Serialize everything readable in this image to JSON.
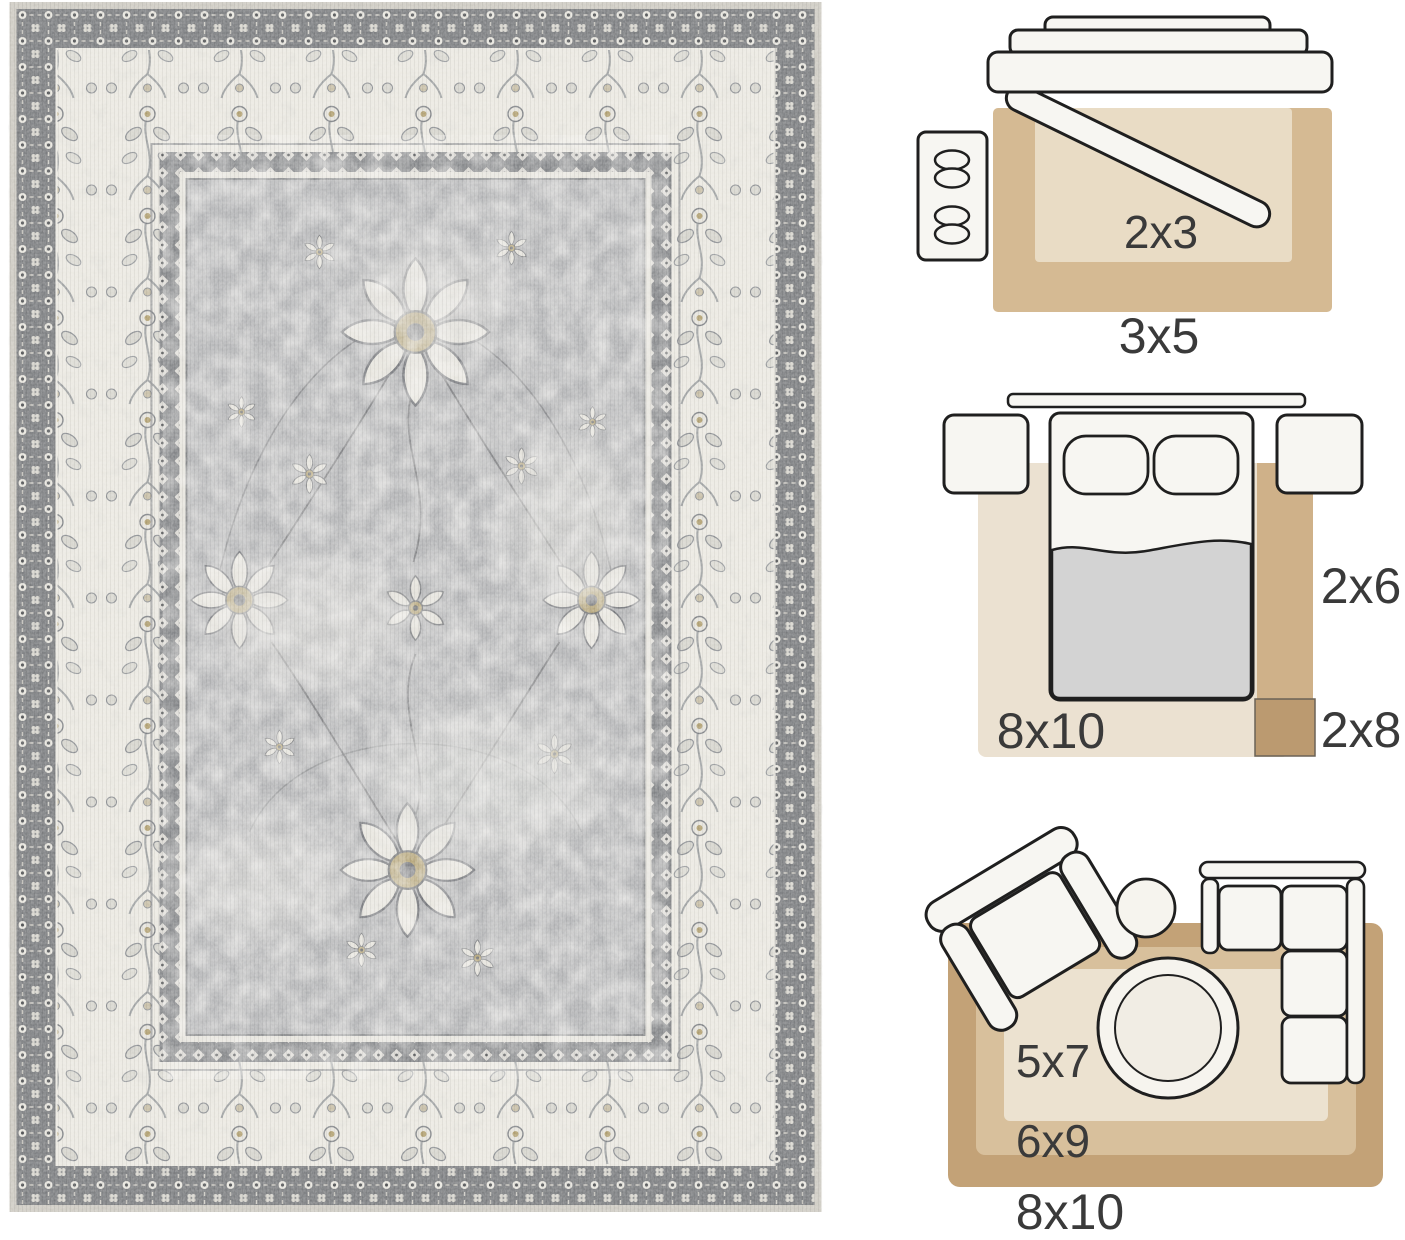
{
  "page": {
    "width": 1405,
    "height": 1233,
    "background": "#ffffff"
  },
  "rug_photo": {
    "description": "distressed vintage oriental area rug, flat top view",
    "colors": {
      "field_gray": "#b5b6b8",
      "border_ivory": "#eceae3",
      "guard_band_dark": "#7e8083",
      "motif_dark": "#5f6163",
      "accent_gold": "#b3a273",
      "edge_binding": "#cfccc4"
    }
  },
  "size_guide": {
    "text_color": "#3a3a3a",
    "outline_color": "#1f1f1f",
    "furniture_fill": "#f7f6f2",
    "scenes": [
      {
        "name": "entryway",
        "furniture": [
          "console-table",
          "bench",
          "cabinet"
        ],
        "rugs": [
          {
            "size": "3x5",
            "color": "#d5ba93"
          },
          {
            "size": "2x3",
            "color": "#e9dcc5"
          }
        ]
      },
      {
        "name": "bedroom",
        "furniture": [
          "headboard",
          "bed",
          "pillows",
          "nightstand-left",
          "nightstand-right"
        ],
        "blanket_color": "#d3d3d3",
        "rugs": [
          {
            "size": "8x10",
            "color": "#ebe1d1"
          },
          {
            "size": "2x6",
            "color": "#cfb189"
          },
          {
            "size": "2x8",
            "color": "#bb9a70"
          }
        ]
      },
      {
        "name": "living-room",
        "furniture": [
          "armchair",
          "side-table",
          "sectional-sofa",
          "round-coffee-table"
        ],
        "rugs": [
          {
            "size": "8x10",
            "color": "#c3a277"
          },
          {
            "size": "6x9",
            "color": "#d8c09c"
          },
          {
            "size": "5x7",
            "color": "#ece2d0"
          }
        ]
      }
    ]
  }
}
